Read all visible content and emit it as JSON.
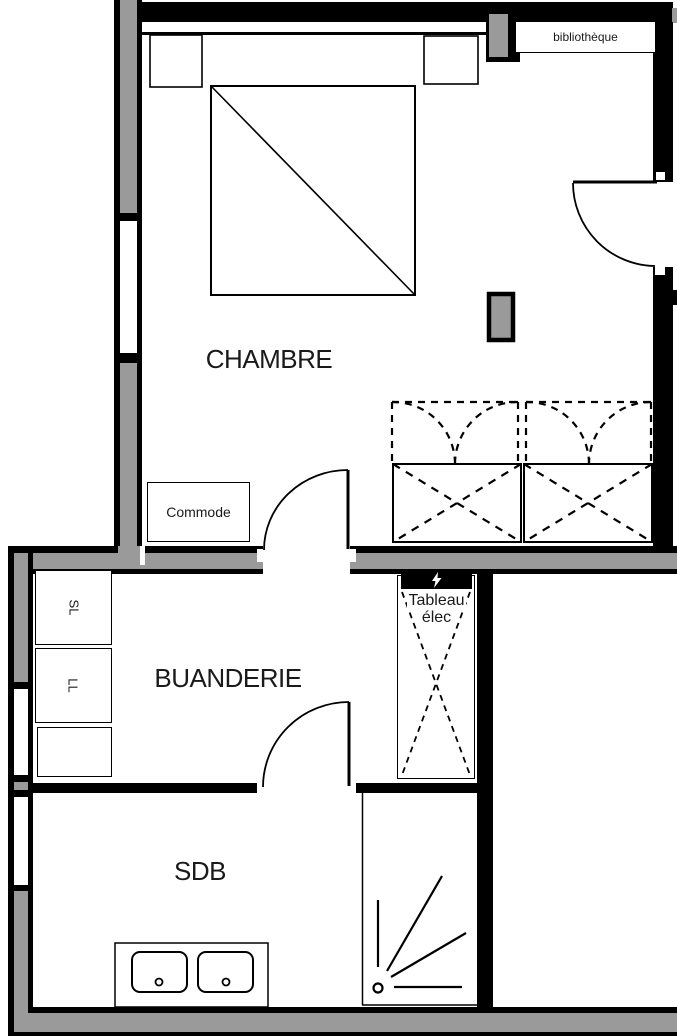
{
  "title": "floor-plan",
  "colors": {
    "wall_black": "#000000",
    "wall_gray": "#9a9a9a",
    "text": "#1a1a1a",
    "background": "#ffffff"
  },
  "rooms": {
    "chambre": {
      "label": "CHAMBRE"
    },
    "buanderie": {
      "label": "BUANDERIE"
    },
    "sdb": {
      "label": "SDB"
    }
  },
  "labels": {
    "bibliotheque": "bibliothèque",
    "commode": "Commode",
    "tableau_line1": "Tableau",
    "tableau_line2": "élec",
    "sl": "SL",
    "ll": "LL"
  },
  "icons": {
    "tableau_header": "lightning-bolt-icon"
  }
}
